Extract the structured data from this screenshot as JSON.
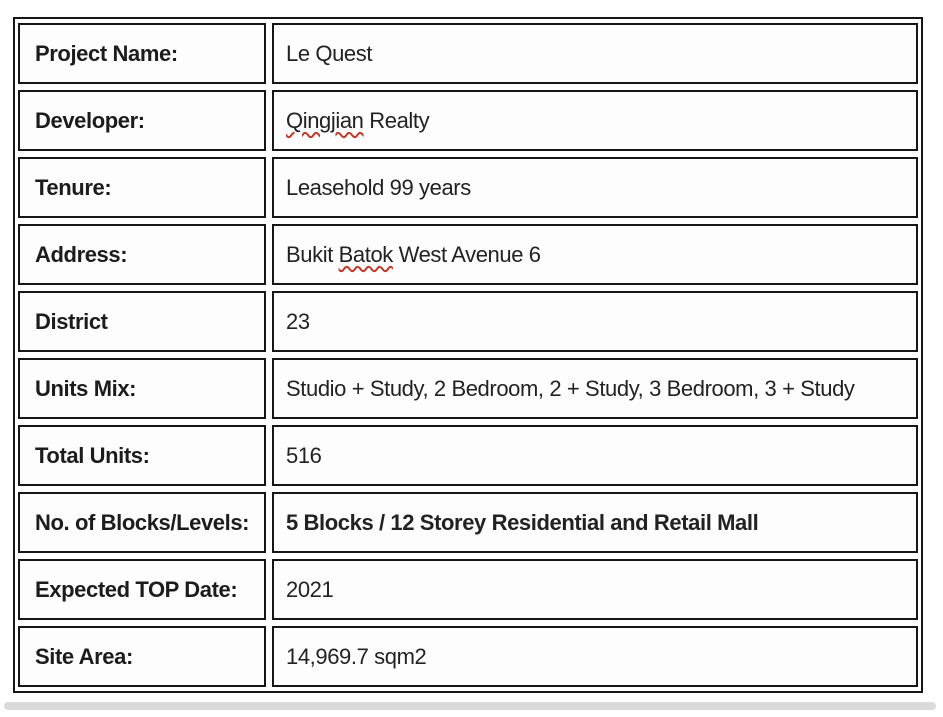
{
  "colors": {
    "table_border": "#161616",
    "label_text": "#1c1c1c",
    "value_text": "#222222",
    "spellcheck_squiggle": "#bd3b2e",
    "bottom_bar": "#dadada",
    "background": "#ffffff"
  },
  "table": {
    "rows": [
      {
        "label": "Project Name:",
        "value": "Le Quest"
      },
      {
        "label": "Developer:",
        "value_pre": "",
        "value_misspelled": "Qingjian",
        "value_post": " Realty"
      },
      {
        "label": "Tenure:",
        "value": "Leasehold 99 years"
      },
      {
        "label": "Address:",
        "value_pre": "Bukit ",
        "value_misspelled": "Batok",
        "value_post": " West Avenue 6"
      },
      {
        "label": "District",
        "value": "23"
      },
      {
        "label": "Units Mix:",
        "value": "Studio + Study, 2 Bedroom, 2 + Study, 3 Bedroom, 3 + Study"
      },
      {
        "label": "Total Units:",
        "value": "516"
      },
      {
        "label": "No. of Blocks/Levels:",
        "value": "5 Blocks / 12 Storey Residential and Retail Mall",
        "bold": true
      },
      {
        "label": "Expected TOP Date:",
        "value": "2021"
      },
      {
        "label": "Site Area:",
        "value": "14,969.7 sqm2"
      }
    ]
  }
}
